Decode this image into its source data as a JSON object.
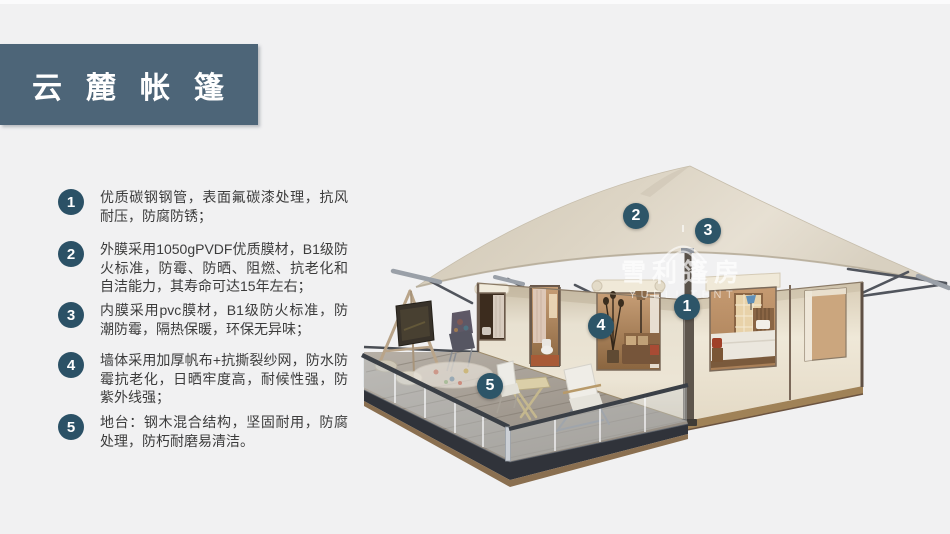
{
  "banner": {
    "title": "云麓帐篷",
    "color": "#4d6578"
  },
  "features": [
    {
      "num": "1",
      "text": "优质碳钢钢管，表面氟碳漆处理，抗风耐压，防腐防锈；"
    },
    {
      "num": "2",
      "text": "外膜采用1050gPVDF优质膜材，B1级防火标准，防霉、防晒、阻燃、抗老化和自洁能力，其寿命可达15年左右；"
    },
    {
      "num": "3",
      "text": "内膜采用pvc膜材，B1级防火标准，防潮防霉，隔热保暖，环保无异味；"
    },
    {
      "num": "4",
      "text": "墙体采用加厚帆布+抗撕裂纱网，防水防霉抗老化，日晒牢度高，耐候性强，防紫外线强；"
    },
    {
      "num": "5",
      "text": "地台：钢木混合结构，坚固耐用，防腐处理，防朽耐磨易清洁。"
    }
  ],
  "illustration": {
    "callouts": [
      {
        "num": "1"
      },
      {
        "num": "2"
      },
      {
        "num": "3"
      },
      {
        "num": "4"
      },
      {
        "num": "5"
      }
    ],
    "watermark": {
      "cn": "雪利篷房",
      "en": "YUELI TENT"
    },
    "badge_color": "#2d5568"
  },
  "colors": {
    "background": "#f1f1f2",
    "accent": "#4d6578",
    "roof": "#dcd4c5",
    "wall": "#e9e2d2"
  }
}
